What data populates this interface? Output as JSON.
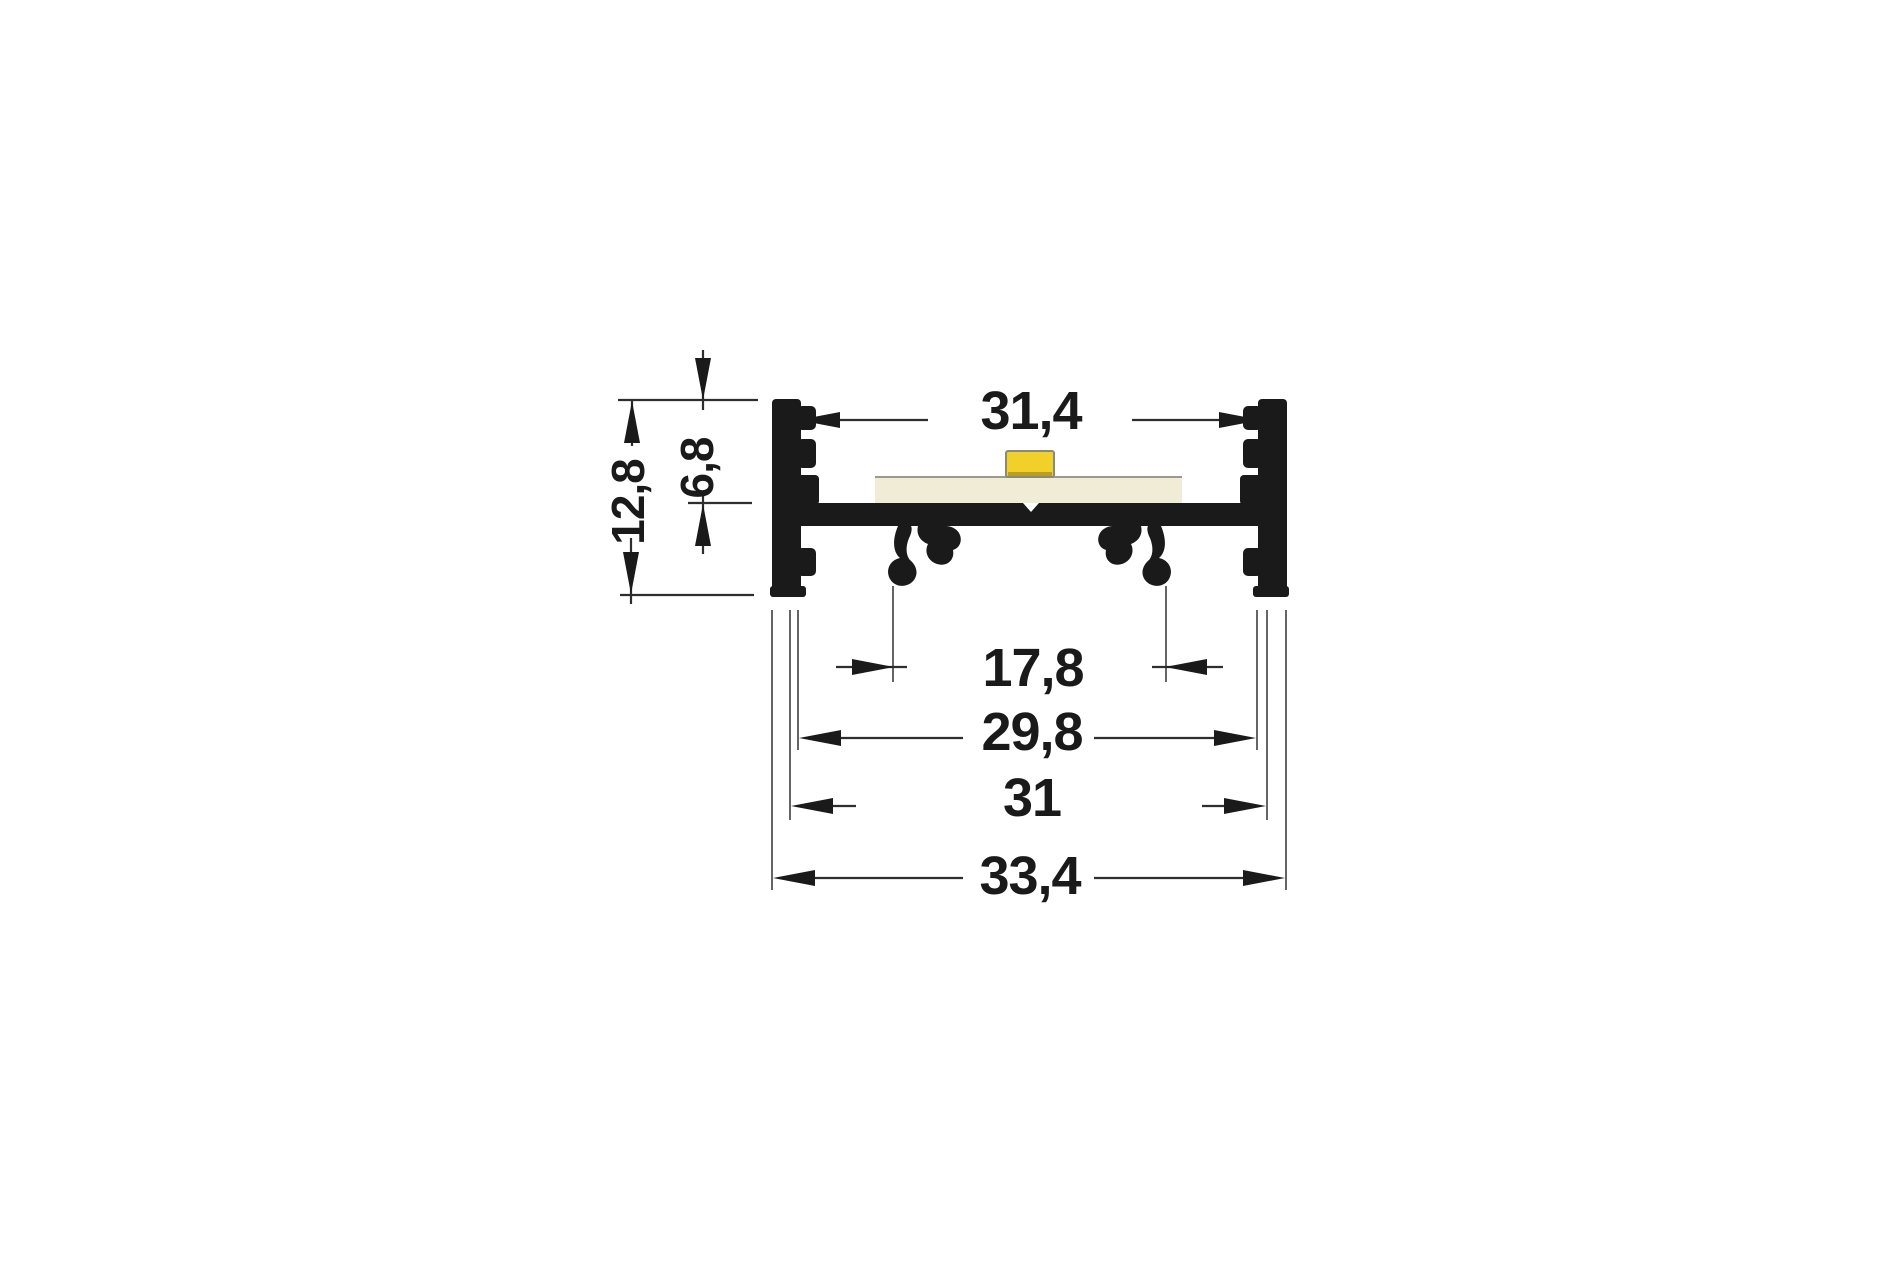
{
  "drawing": {
    "kind": "profile-cross-section-dimension-drawing",
    "dimension_labels": {
      "inner_top_width": "31,4",
      "upper_height": "6,8",
      "total_height": "12,8",
      "clip_spacing": "17,8",
      "inner_bottom_width": "29,8",
      "groove_width": "31",
      "total_width": "33,4"
    },
    "colors": {
      "profile_black": "#1a1a1a",
      "led_yellow": "#f2d02a",
      "pcb_cream": "#f0ecd6",
      "background": "#ffffff"
    }
  }
}
